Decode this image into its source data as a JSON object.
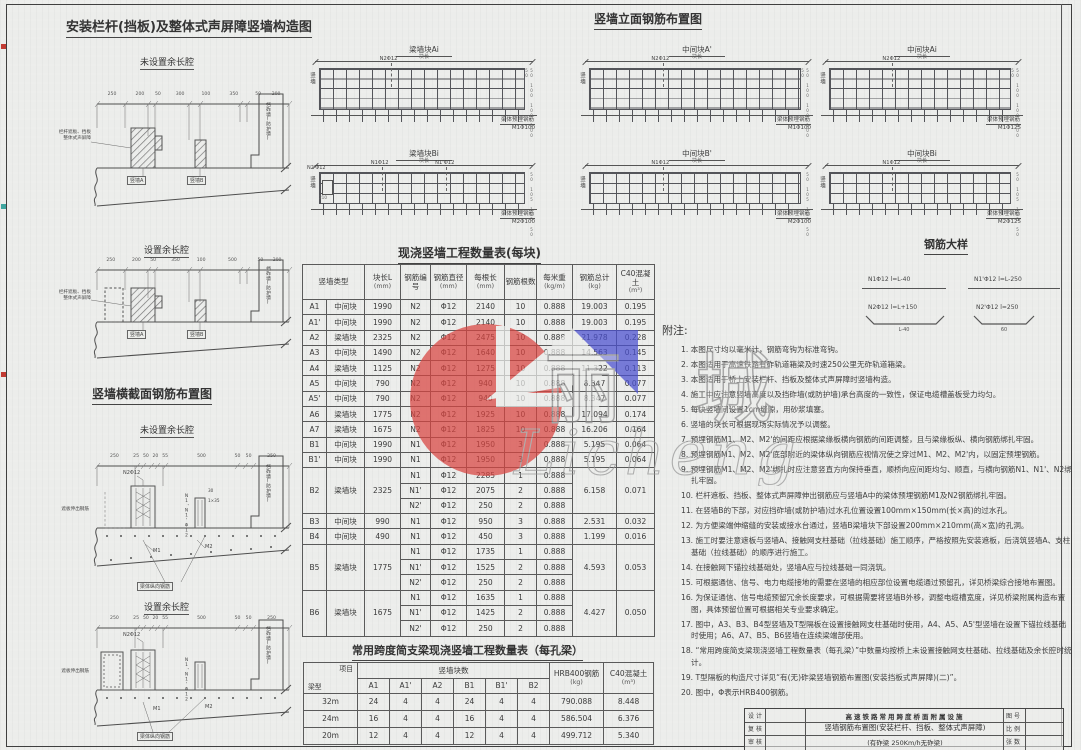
{
  "construction": {
    "title": "安装栏杆(挡板)及整体式声屏障竖墙构造图",
    "sub1": "未设置余长腔",
    "sub2": "设置余长腔",
    "callout_line1": "栏杆遮板、挡板",
    "callout_line2": "整体式声屏障",
    "wall_a": "竖墙A",
    "wall_b": "竖墙B",
    "ballast_wall": "挡砟墙(防护墙)",
    "dims1": [
      "250",
      "200",
      "50",
      "300",
      "100",
      "350",
      "50",
      "200"
    ],
    "dims2": [
      "250",
      "200",
      "50",
      "350",
      "100",
      "500",
      "50",
      "200"
    ]
  },
  "cross_section": {
    "title": "竖墙横截面钢筋布置图",
    "sub1": "未设置余长腔",
    "sub2": "设置余长腔",
    "callout_n2": "N2Φ12",
    "label_n1": "N1、N1'Φ12",
    "label_m1": "M1",
    "label_m2": "M2",
    "callout_left": "遮板伸出钢筋",
    "callout_bottom": "梁体纵向钢筋",
    "ballast_wall": "挡砟墙(防护墙)",
    "small_dim1": "30",
    "small_dim2": "1×35",
    "dims": [
      "250",
      "25",
      "50",
      "20",
      "55",
      "500",
      "50",
      "50",
      "250"
    ]
  },
  "elevation": {
    "title": "竖墙立面钢筋布置图",
    "panels": [
      {
        "name": "梁墙块Ai",
        "dim_label": "块长",
        "side": "竖墙",
        "callouts": [
          {
            "label": "N2Φ12",
            "x": 30
          }
        ],
        "bottom_line1": "梁体预埋钢筋",
        "bottom_line2": "M1Φ100",
        "right_dims": "50 100 100 100 50",
        "tall": true
      },
      {
        "name": "中间块A'",
        "dim_label": "块长",
        "side": "竖墙",
        "callouts": [
          {
            "label": "N2Φ12",
            "x": 30
          }
        ],
        "bottom_line1": "梁体预埋钢筋",
        "bottom_line2": "M1Φ100",
        "right_dims": "50 100 100 100 50",
        "tall": true
      },
      {
        "name": "中间块Ai",
        "dim_label": "块长",
        "side": "竖墙",
        "callouts": [
          {
            "label": "N2Φ12",
            "x": 30
          }
        ],
        "bottom_line1": "梁体预埋钢筋",
        "bottom_line2": "M1Φ125",
        "right_dims": "50 100 100 100 50",
        "tall": true
      },
      {
        "name": "梁墙块Bi",
        "dim_label": "块长",
        "side": "竖墙",
        "callouts": [
          {
            "label": "N1Φ12",
            "x": 26
          },
          {
            "label": "N1'Φ12",
            "x": 55
          }
        ],
        "left_bar": "N2'Φ12",
        "left_dim": "210",
        "bottom_line1": "梁体预埋钢筋",
        "bottom_line2": "M2Φ100",
        "right_dims": "50 105 105 50",
        "tall": false
      },
      {
        "name": "中间块B'",
        "dim_label": "块长",
        "side": "竖墙",
        "callouts": [
          {
            "label": "N1Φ12",
            "x": 30
          }
        ],
        "bottom_line1": "梁体预埋钢筋",
        "bottom_line2": "M2Φ100",
        "right_dims": "50 105 105 50",
        "tall": false
      },
      {
        "name": "中间块Bi",
        "dim_label": "块长",
        "side": "竖墙",
        "callouts": [
          {
            "label": "N1Φ12",
            "x": 30
          }
        ],
        "bottom_line1": "梁体预埋钢筋",
        "bottom_line2": "M2Φ125",
        "right_dims": "50 105 105 50",
        "tall": false
      }
    ]
  },
  "rebar_details": {
    "title": "钢筋大样",
    "item1": {
      "label": "N1Φ12 l=L-40"
    },
    "item2": {
      "label": "N1'Φ12 l=L-250"
    },
    "item3": {
      "label": "N2Φ12 l=L+150",
      "dim": "L-40"
    },
    "item4": {
      "label": "N2'Φ12 l=250",
      "dim": "60"
    }
  },
  "main_table": {
    "title": "现浇竖墙工程数量表(每块)",
    "col_headers": [
      {
        "label": "竖墙类型",
        "unit": "",
        "span": 2
      },
      {
        "label": "块长L",
        "unit": "(mm)"
      },
      {
        "label": "钢筋编号",
        "unit": ""
      },
      {
        "label": "钢筋直径",
        "unit": "(mm)"
      },
      {
        "label": "每根长",
        "unit": "(mm)"
      },
      {
        "label": "钢筋根数",
        "unit": ""
      },
      {
        "label": "每米重",
        "unit": "(kg/m)"
      },
      {
        "label": "钢筋总计",
        "unit": "(kg)"
      },
      {
        "label": "C40混凝土",
        "unit": "(m³)"
      }
    ],
    "rows": [
      {
        "code": "A1",
        "type": "中间块",
        "len": "1990",
        "bars": [
          {
            "no": "N2",
            "dia": "Φ12",
            "each": "2140",
            "count": "10",
            "unitw": "0.888"
          }
        ],
        "total": "19.003",
        "conc": "0.195"
      },
      {
        "code": "A1'",
        "type": "中间块",
        "len": "1990",
        "bars": [
          {
            "no": "N2",
            "dia": "Φ12",
            "each": "2140",
            "count": "10",
            "unitw": "0.888"
          }
        ],
        "total": "19.003",
        "conc": "0.195"
      },
      {
        "code": "A2",
        "type": "梁墙块",
        "len": "2325",
        "bars": [
          {
            "no": "N2",
            "dia": "Φ12",
            "each": "2475",
            "count": "10",
            "unitw": "0.888"
          }
        ],
        "total": "21.978",
        "conc": "0.228"
      },
      {
        "code": "A3",
        "type": "中间块",
        "len": "1490",
        "bars": [
          {
            "no": "N2",
            "dia": "Φ12",
            "each": "1640",
            "count": "10",
            "unitw": "0.888"
          }
        ],
        "total": "14.563",
        "conc": "0.145"
      },
      {
        "code": "A4",
        "type": "梁墙块",
        "len": "1125",
        "bars": [
          {
            "no": "N2",
            "dia": "Φ12",
            "each": "1275",
            "count": "10",
            "unitw": "0.888"
          }
        ],
        "total": "11.322",
        "conc": "0.113"
      },
      {
        "code": "A5",
        "type": "中间块",
        "len": "790",
        "bars": [
          {
            "no": "N2",
            "dia": "Φ12",
            "each": "940",
            "count": "10",
            "unitw": "0.888"
          }
        ],
        "total": "8.347",
        "conc": "0.077"
      },
      {
        "code": "A5'",
        "type": "中间块",
        "len": "790",
        "bars": [
          {
            "no": "N2",
            "dia": "Φ12",
            "each": "940",
            "count": "10",
            "unitw": "0.888"
          }
        ],
        "total": "8.347",
        "conc": "0.077"
      },
      {
        "code": "A6",
        "type": "梁墙块",
        "len": "1775",
        "bars": [
          {
            "no": "N2",
            "dia": "Φ12",
            "each": "1925",
            "count": "10",
            "unitw": "0.888"
          }
        ],
        "total": "17.094",
        "conc": "0.174"
      },
      {
        "code": "A7",
        "type": "梁墙块",
        "len": "1675",
        "bars": [
          {
            "no": "N2",
            "dia": "Φ12",
            "each": "1825",
            "count": "10",
            "unitw": "0.888"
          }
        ],
        "total": "16.206",
        "conc": "0.164"
      },
      {
        "code": "B1",
        "type": "中间块",
        "len": "1990",
        "bars": [
          {
            "no": "N1",
            "dia": "Φ12",
            "each": "1950",
            "count": "3",
            "unitw": "0.888"
          }
        ],
        "total": "5.195",
        "conc": "0.064"
      },
      {
        "code": "B1'",
        "type": "中间块",
        "len": "1990",
        "bars": [
          {
            "no": "N1",
            "dia": "Φ12",
            "each": "1950",
            "count": "3",
            "unitw": "0.888"
          }
        ],
        "total": "5.195",
        "conc": "0.064"
      },
      {
        "code": "B2",
        "type": "梁墙块",
        "len": "2325",
        "bars": [
          {
            "no": "N1",
            "dia": "Φ12",
            "each": "2285",
            "count": "1",
            "unitw": "0.888"
          },
          {
            "no": "N1'",
            "dia": "Φ12",
            "each": "2075",
            "count": "2",
            "unitw": "0.888"
          },
          {
            "no": "N2'",
            "dia": "Φ12",
            "each": "250",
            "count": "2",
            "unitw": "0.888"
          }
        ],
        "total": "6.158",
        "conc": "0.071"
      },
      {
        "code": "B3",
        "type": "中间块",
        "len": "990",
        "bars": [
          {
            "no": "N1",
            "dia": "Φ12",
            "each": "950",
            "count": "3",
            "unitw": "0.888"
          }
        ],
        "total": "2.531",
        "conc": "0.032"
      },
      {
        "code": "B4",
        "type": "中间块",
        "len": "490",
        "bars": [
          {
            "no": "N1",
            "dia": "Φ12",
            "each": "450",
            "count": "3",
            "unitw": "0.888"
          }
        ],
        "total": "1.199",
        "conc": "0.016"
      },
      {
        "code": "B5",
        "type": "梁墙块",
        "len": "1775",
        "bars": [
          {
            "no": "N1",
            "dia": "Φ12",
            "each": "1735",
            "count": "1",
            "unitw": "0.888"
          },
          {
            "no": "N1'",
            "dia": "Φ12",
            "each": "1525",
            "count": "2",
            "unitw": "0.888"
          },
          {
            "no": "N2'",
            "dia": "Φ12",
            "each": "250",
            "count": "2",
            "unitw": "0.888"
          }
        ],
        "total": "4.593",
        "conc": "0.053"
      },
      {
        "code": "B6",
        "type": "梁墙块",
        "len": "1675",
        "bars": [
          {
            "no": "N1",
            "dia": "Φ12",
            "each": "1635",
            "count": "1",
            "unitw": "0.888"
          },
          {
            "no": "N1'",
            "dia": "Φ12",
            "each": "1425",
            "count": "2",
            "unitw": "0.888"
          },
          {
            "no": "N2'",
            "dia": "Φ12",
            "each": "250",
            "count": "2",
            "unitw": "0.888"
          }
        ],
        "total": "4.427",
        "conc": "0.050"
      }
    ]
  },
  "span_table": {
    "title": "常用跨度简支梁现浇竖墙工程数量表（每孔梁）",
    "corner_top": "项目",
    "corner_bottom": "梁型",
    "group_label": "竖墙块数",
    "block_cols": [
      "A1",
      "A1'",
      "A2",
      "B1",
      "B1'",
      "B2"
    ],
    "rebar_col": {
      "label": "HRB400钢筋",
      "unit": "(kg)"
    },
    "conc_col": {
      "label": "C40混凝土",
      "unit": "(m³)"
    },
    "rows": [
      {
        "span": "32m",
        "counts": [
          "24",
          "4",
          "4",
          "24",
          "4",
          "4"
        ],
        "rebar": "790.088",
        "conc": "8.448"
      },
      {
        "span": "24m",
        "counts": [
          "16",
          "4",
          "4",
          "16",
          "4",
          "4"
        ],
        "rebar": "586.504",
        "conc": "6.376"
      },
      {
        "span": "20m",
        "counts": [
          "12",
          "4",
          "4",
          "12",
          "4",
          "4"
        ],
        "rebar": "499.712",
        "conc": "5.340"
      }
    ]
  },
  "notes": {
    "title": "附注:",
    "items": [
      "1. 本图尺寸均以毫米计，钢筋弯钩为标准弯钩。",
      "2. 本图适用于高速铁路有砟轨道箱梁及时速250公里无砟轨道箱梁。",
      "3. 本图适用于桥上安装栏杆、挡板及整体式声屏障时竖墙构造。",
      "4. 施工中应注意竖墙高度以及挡砟墙(或防护墙)承台高度的一致性，保证电缆槽盖板受力均匀。",
      "5. 每块竖墙间设置1cm缝隙，用砂浆填塞。",
      "6. 竖墙的块长可根据现场实际情况予以调整。",
      "7. 预埋钢筋M1、M2、M2'的间距应根据梁缘板横向钢筋的间距调整，且与梁缘板纵、横向钢筋绑扎牢固。",
      "8. 预埋钢筋M1、M2、M2'底部附近的梁体纵向钢筋应视情况使之穿过M1、M2、M2'内，以固定预埋钢筋。",
      "9. 预埋钢筋M1、M2、M2'绑扎时应注意竖直方向保持垂直，顺桥向应间距均匀、顺直，与横向钢筋N1、N1'、N2绑扎牢固。",
      "10. 栏杆遮板、挡板、整体式声屏障伸出钢筋应与竖墙A中的梁体预埋钢筋M1及N2钢筋绑扎牢固。",
      "11. 在竖墙B的下部，对应挡砟墙(或防护墙)过水孔位置设置100mm×150mm(长×高)的过水孔。",
      "12. 为方便梁端伸缩缝的安装或接水台通过，竖墙B梁墙块下部设置200mm×210mm(高×宽)的孔洞。",
      "13. 施工时要注意遮板与竖墙A、接触网支柱基础（拉线基础）施工顺序，严格按照先安装遮板，后浇筑竖墙A、支柱基础（拉线基础）的顺序进行施工。",
      "14. 在接触网下锚拉线基础处，竖墙A应与拉线基础一同浇筑。",
      "15. 可根据通信、信号、电力电缆接地的需要在竖墙的相应部位设置电缆通过预留孔，详见桥梁综合接地布置图。",
      "16. 为保证通信、信号电缆预留冗余长度要求，可根据需要将竖墙B外移，调整电缆槽宽度，详见桥梁附属构造布置图，具体预留位置可根据相关专业要求确定。",
      "17. 图中，A3、B3、B4型竖墙及T型隔板在设置接触网支柱基础时使用，A4、A5、A5'型竖墙在设置下锚拉线基础时使用；A6、A7、B5、B6竖墙在连续梁端部使用。",
      "18. “常用跨度简支梁现浇竖墙工程数量表（每孔梁）”中数量均按桥上未设置接触网支柱基础、拉线基础及余长腔时统计。",
      "19. T型隔板的构造尺寸详见“有(无)砟梁竖墙钢筋布置图(安装挡板式声屏障)(二)”。",
      "20. 图中，Φ表示HRB400钢筋。"
    ]
  },
  "title_block": {
    "design_label": "设计",
    "check_label": "复核",
    "review_label": "审核",
    "title_line1": "高速铁路常用跨度桥面附属设施",
    "title_line2": "竖墙钢筋布置图(安装栏杆、挡板、整体式声屏障)",
    "title_line3": "(有砟梁 250Km/h无砟梁)",
    "drawing_no_label": "图号",
    "scale_label": "比例",
    "sheets_label": "张数"
  },
  "watermark": {
    "text": "丽  城",
    "script": "Licheng",
    "red": "#d94440",
    "blue": "#4a4fd0"
  }
}
